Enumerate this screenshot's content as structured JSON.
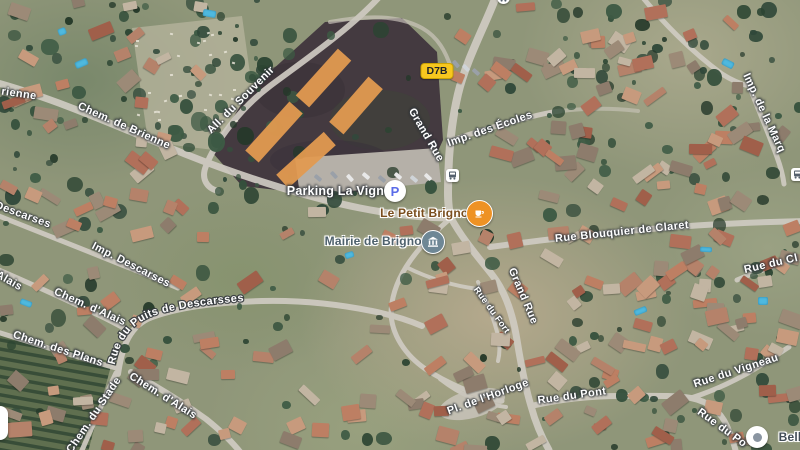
{
  "map": {
    "title": "Satellite map of Brignon village with four orange overlay rectangles on the field by Parking La Vigne",
    "route_shield": {
      "label": "D7B",
      "x": 437,
      "y": 71,
      "bg": "#F7C71F"
    },
    "overlay_rectangles": {
      "color": "#E19A50",
      "rects": [
        {
          "cx": 323,
          "cy": 78,
          "w": 63,
          "h": 18,
          "rot": -48
        },
        {
          "cx": 356,
          "cy": 105,
          "w": 60,
          "h": 19,
          "rot": -49
        },
        {
          "cx": 274,
          "cy": 132,
          "w": 66,
          "h": 18,
          "rot": -48
        },
        {
          "cx": 306,
          "cy": 160,
          "w": 64,
          "h": 18,
          "rot": -42
        }
      ]
    },
    "road_labels": [
      {
        "text": "rienne",
        "x": 19,
        "y": 94,
        "rot": 8
      },
      {
        "text": "Chem. de Brienne",
        "x": 124,
        "y": 126,
        "rot": 24
      },
      {
        "text": "All. du Souvenir",
        "x": 241,
        "y": 100,
        "rot": -45
      },
      {
        "text": "Grand Rue",
        "x": 426,
        "y": 135,
        "rot": 60
      },
      {
        "text": "Imp. des Écoles",
        "x": 490,
        "y": 129,
        "rot": -19
      },
      {
        "text": "Rue Blouquier de Claret",
        "x": 622,
        "y": 232,
        "rot": -6
      },
      {
        "text": "Grand Rue",
        "x": 523,
        "y": 296,
        "rot": 67
      },
      {
        "text": "Rue du Fort",
        "x": 492,
        "y": 310,
        "rot": 54,
        "size": 9
      },
      {
        "text": "Descarses",
        "x": 23,
        "y": 215,
        "rot": 20
      },
      {
        "text": "Imp. Descarses",
        "x": 131,
        "y": 265,
        "rot": 27
      },
      {
        "text": "Alais",
        "x": 9,
        "y": 281,
        "rot": 30
      },
      {
        "text": "Chem. d'Alais",
        "x": 90,
        "y": 307,
        "rot": 24
      },
      {
        "text": "Chem. des Plans",
        "x": 58,
        "y": 349,
        "rot": 18
      },
      {
        "text": "Chem. du Stade",
        "x": 94,
        "y": 415,
        "rot": -56
      },
      {
        "text": "Chem. d'Alais",
        "x": 163,
        "y": 396,
        "rot": 32
      },
      {
        "text": "Pl. de l'Horloge",
        "x": 488,
        "y": 397,
        "rot": -20
      },
      {
        "text": "Rue du Pont",
        "x": 572,
        "y": 396,
        "rot": -8
      },
      {
        "text": "Rue du Vigneau",
        "x": 736,
        "y": 371,
        "rot": -18
      },
      {
        "text": "Rue du Po",
        "x": 722,
        "y": 428,
        "rot": 36
      },
      {
        "text": "Rue du Cl",
        "x": 771,
        "y": 264,
        "rot": -13
      },
      {
        "text": "Imp. de la Marq",
        "x": 764,
        "y": 113,
        "rot": 65
      }
    ],
    "curved_label": {
      "text": "Rue du Puits de Descarsses"
    },
    "pois": [
      {
        "id": "parking-la-vigne",
        "label": "Parking La Vigne",
        "icon": "parking-icon",
        "style": "white",
        "accent": "#5A6BE8",
        "tx": 339,
        "ty": 191,
        "ix": 395,
        "iy": 191
      },
      {
        "id": "le-petit-brignon",
        "label": "Le Petit Brignon",
        "icon": "cafe-icon",
        "style": "amber",
        "accent": "#EE9224",
        "tx": 428,
        "ty": 213,
        "ix": 478,
        "iy": 212
      },
      {
        "id": "mairie-de-brignon",
        "label": "Mairie de Brignon",
        "icon": "town-hall-icon",
        "style": "slate",
        "accent": "#6E8795",
        "tx": 377,
        "ty": 241,
        "ix": 432,
        "iy": 241
      },
      {
        "id": "bell",
        "label": "Bell",
        "icon": "poi-dot-icon",
        "style": "dark",
        "accent": "#8A95A1",
        "tx": 790,
        "ty": 437,
        "ix": 757,
        "iy": 437
      }
    ],
    "transit_stops": [
      {
        "x": 452,
        "y": 175,
        "shape": "square"
      },
      {
        "x": 797,
        "y": 174,
        "shape": "square"
      },
      {
        "x": 503,
        "y": -3,
        "shape": "circle"
      }
    ],
    "label_colors": {
      "white": "#FFFFFF",
      "amber": "#7A4E1E",
      "slate": "#4E616D",
      "dark": "#424D57"
    }
  }
}
